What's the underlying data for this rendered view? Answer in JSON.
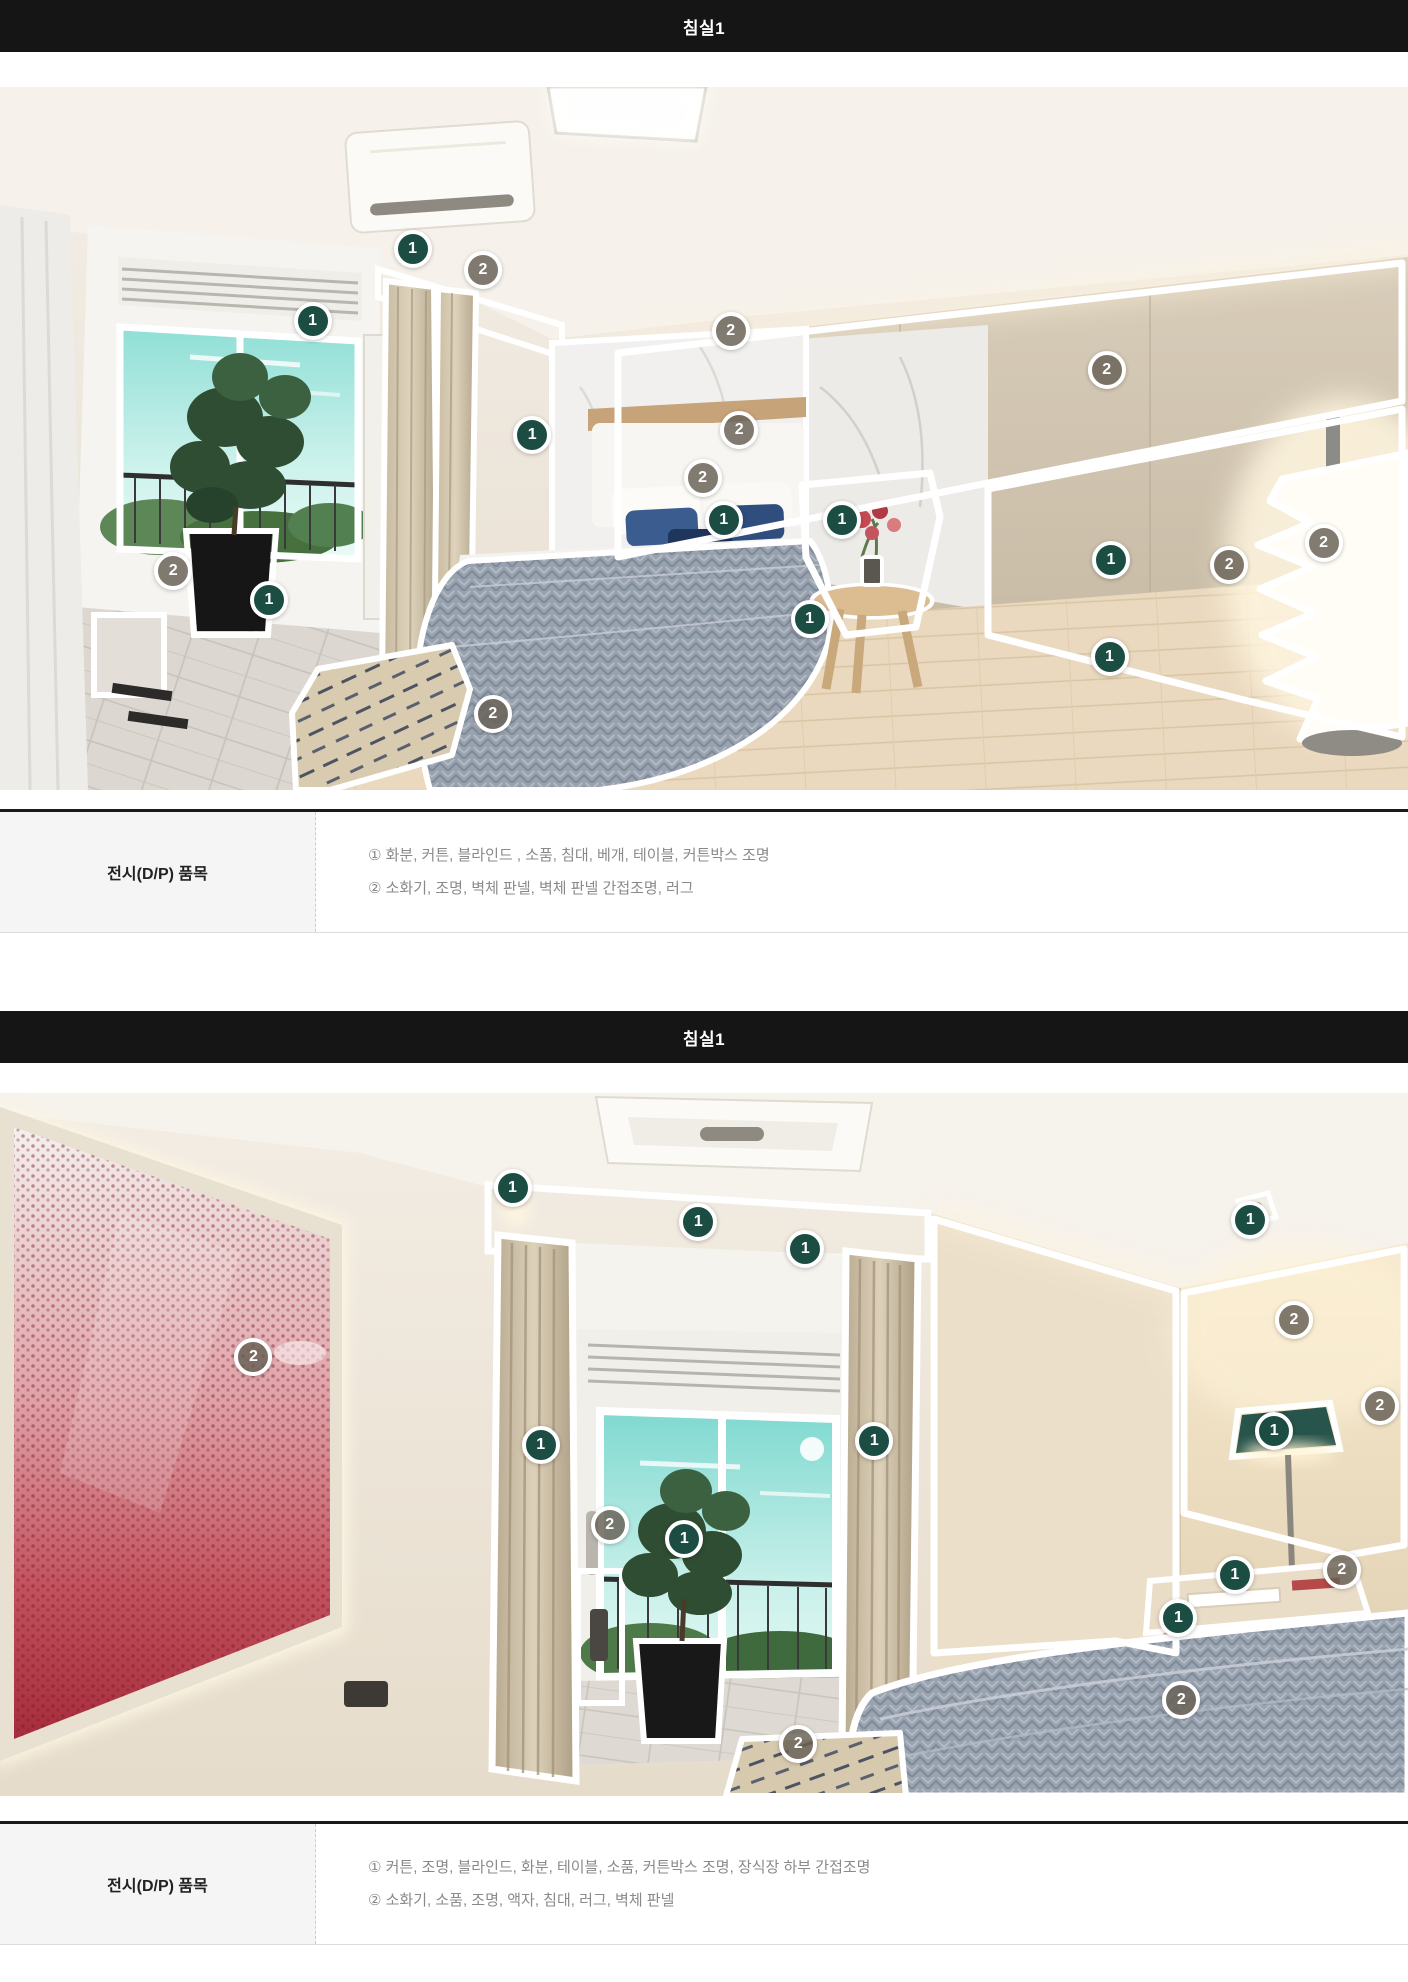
{
  "colors": {
    "header_bg": "#151515",
    "header_text": "#ffffff",
    "marker_1_bg": "#1b4d43",
    "marker_2_bg": "#686055",
    "table_top_border": "#1a1a1a",
    "table_label_bg": "#f5f5f5",
    "table_text": "#8a8a8a"
  },
  "sections": [
    {
      "header": "침실1",
      "table": {
        "label": "전시(D/P) 품목",
        "rows": [
          "① 화분, 커튼, 블라인드 , 소품, 침대, 베개, 테이블, 커튼박스 조명",
          "② 소화기, 조명, 벽체 판넬, 벽체 판넬 간접조명, 러그"
        ]
      },
      "markers": [
        {
          "n": "1",
          "x": 29.3,
          "y": 23.0
        },
        {
          "n": "2",
          "x": 34.3,
          "y": 26.0
        },
        {
          "n": "1",
          "x": 22.2,
          "y": 33.3
        },
        {
          "n": "1",
          "x": 37.8,
          "y": 49.5
        },
        {
          "n": "2",
          "x": 51.9,
          "y": 34.7
        },
        {
          "n": "2",
          "x": 78.6,
          "y": 40.3
        },
        {
          "n": "2",
          "x": 52.5,
          "y": 48.8
        },
        {
          "n": "2",
          "x": 49.9,
          "y": 55.6
        },
        {
          "n": "1",
          "x": 51.4,
          "y": 61.6
        },
        {
          "n": "1",
          "x": 59.8,
          "y": 61.6
        },
        {
          "n": "1",
          "x": 57.5,
          "y": 75.7
        },
        {
          "n": "2",
          "x": 12.3,
          "y": 68.8
        },
        {
          "n": "1",
          "x": 19.1,
          "y": 73.0
        },
        {
          "n": "1",
          "x": 78.9,
          "y": 67.3
        },
        {
          "n": "2",
          "x": 87.3,
          "y": 68.0
        },
        {
          "n": "1",
          "x": 78.8,
          "y": 81.1
        },
        {
          "n": "2",
          "x": 94.0,
          "y": 64.9
        },
        {
          "n": "2",
          "x": 35.0,
          "y": 89.2
        }
      ]
    },
    {
      "header": "침실1",
      "table": {
        "label": "전시(D/P) 품목",
        "rows": [
          "① 커튼, 조명, 블라인드, 화분, 테이블, 소품, 커튼박스 조명, 장식장 하부 간접조명",
          "② 소화기, 소품, 조명, 액자, 침대, 러그, 벽체 판넬"
        ]
      },
      "markers": [
        {
          "n": "1",
          "x": 36.4,
          "y": 13.5
        },
        {
          "n": "1",
          "x": 49.6,
          "y": 18.4
        },
        {
          "n": "1",
          "x": 57.2,
          "y": 22.2
        },
        {
          "n": "1",
          "x": 88.8,
          "y": 18.1
        },
        {
          "n": "2",
          "x": 91.9,
          "y": 32.3
        },
        {
          "n": "2",
          "x": 98.0,
          "y": 44.5
        },
        {
          "n": "2",
          "x": 18.0,
          "y": 37.6
        },
        {
          "n": "1",
          "x": 38.4,
          "y": 50.1
        },
        {
          "n": "1",
          "x": 62.1,
          "y": 49.5
        },
        {
          "n": "2",
          "x": 43.3,
          "y": 61.4
        },
        {
          "n": "1",
          "x": 48.6,
          "y": 63.5
        },
        {
          "n": "1",
          "x": 90.5,
          "y": 48.1
        },
        {
          "n": "2",
          "x": 95.3,
          "y": 67.9
        },
        {
          "n": "1",
          "x": 87.7,
          "y": 68.6
        },
        {
          "n": "1",
          "x": 83.7,
          "y": 74.7
        },
        {
          "n": "2",
          "x": 83.9,
          "y": 86.3
        },
        {
          "n": "2",
          "x": 56.7,
          "y": 92.6
        }
      ]
    }
  ]
}
